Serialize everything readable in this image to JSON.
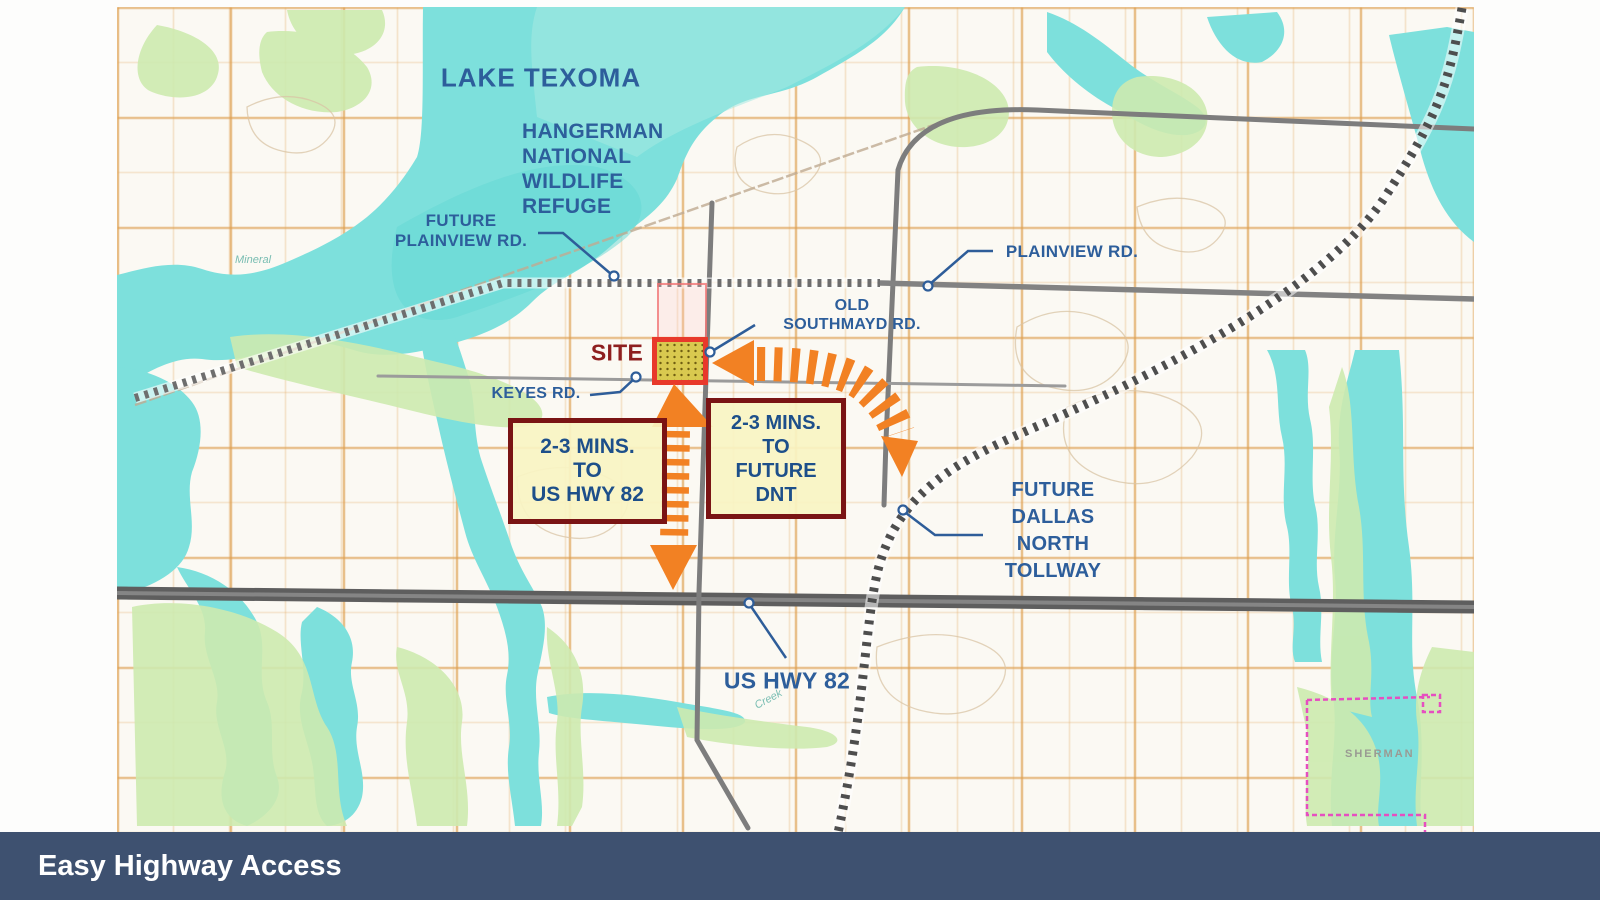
{
  "banner": {
    "title": "Easy Highway Access"
  },
  "map": {
    "labels": {
      "lake": "LAKE TEXOMA",
      "refuge_lines": [
        "HANGERMAN",
        "NATIONAL",
        "WILDLIFE",
        "REFUGE"
      ],
      "future_plainview_lines": [
        "FUTURE",
        "PLAINVIEW RD."
      ],
      "plainview": "PLAINVIEW RD.",
      "old_southmayd_lines": [
        "OLD",
        "SOUTHMAYD RD."
      ],
      "site": "SITE",
      "keyes": "KEYES RD.",
      "us_hwy": "US HWY 82",
      "future_dnt_lines": [
        "FUTURE",
        "DALLAS",
        "NORTH",
        "TOLLWAY"
      ]
    },
    "callouts": {
      "box_us82_lines": [
        "2-3 MINS.",
        "TO",
        "US HWY 82"
      ],
      "box_dnt_lines": [
        "2-3 MINS.",
        "TO",
        "FUTURE",
        "DNT"
      ]
    },
    "base_labels": {
      "city": "SHERMAN",
      "creek": "Creek",
      "mineral": "Mineral"
    },
    "colors": {
      "label_blue": "#2d5e9b",
      "site_red": "#8e1f1f",
      "site_marker_border": "#e8392b",
      "site_marker_fill": "#d9c94f",
      "callout_border": "#7a1414",
      "callout_fill": "#f8f4c3",
      "callout_text": "#1d4f8a",
      "arrow_orange": "#f28123",
      "water": "#7de0dc",
      "vegetation": "#cdeaaf",
      "road_gray": "#6b6b6b",
      "banner_bg": "#3e5170",
      "boundary_magenta": "#e64fc0"
    }
  }
}
